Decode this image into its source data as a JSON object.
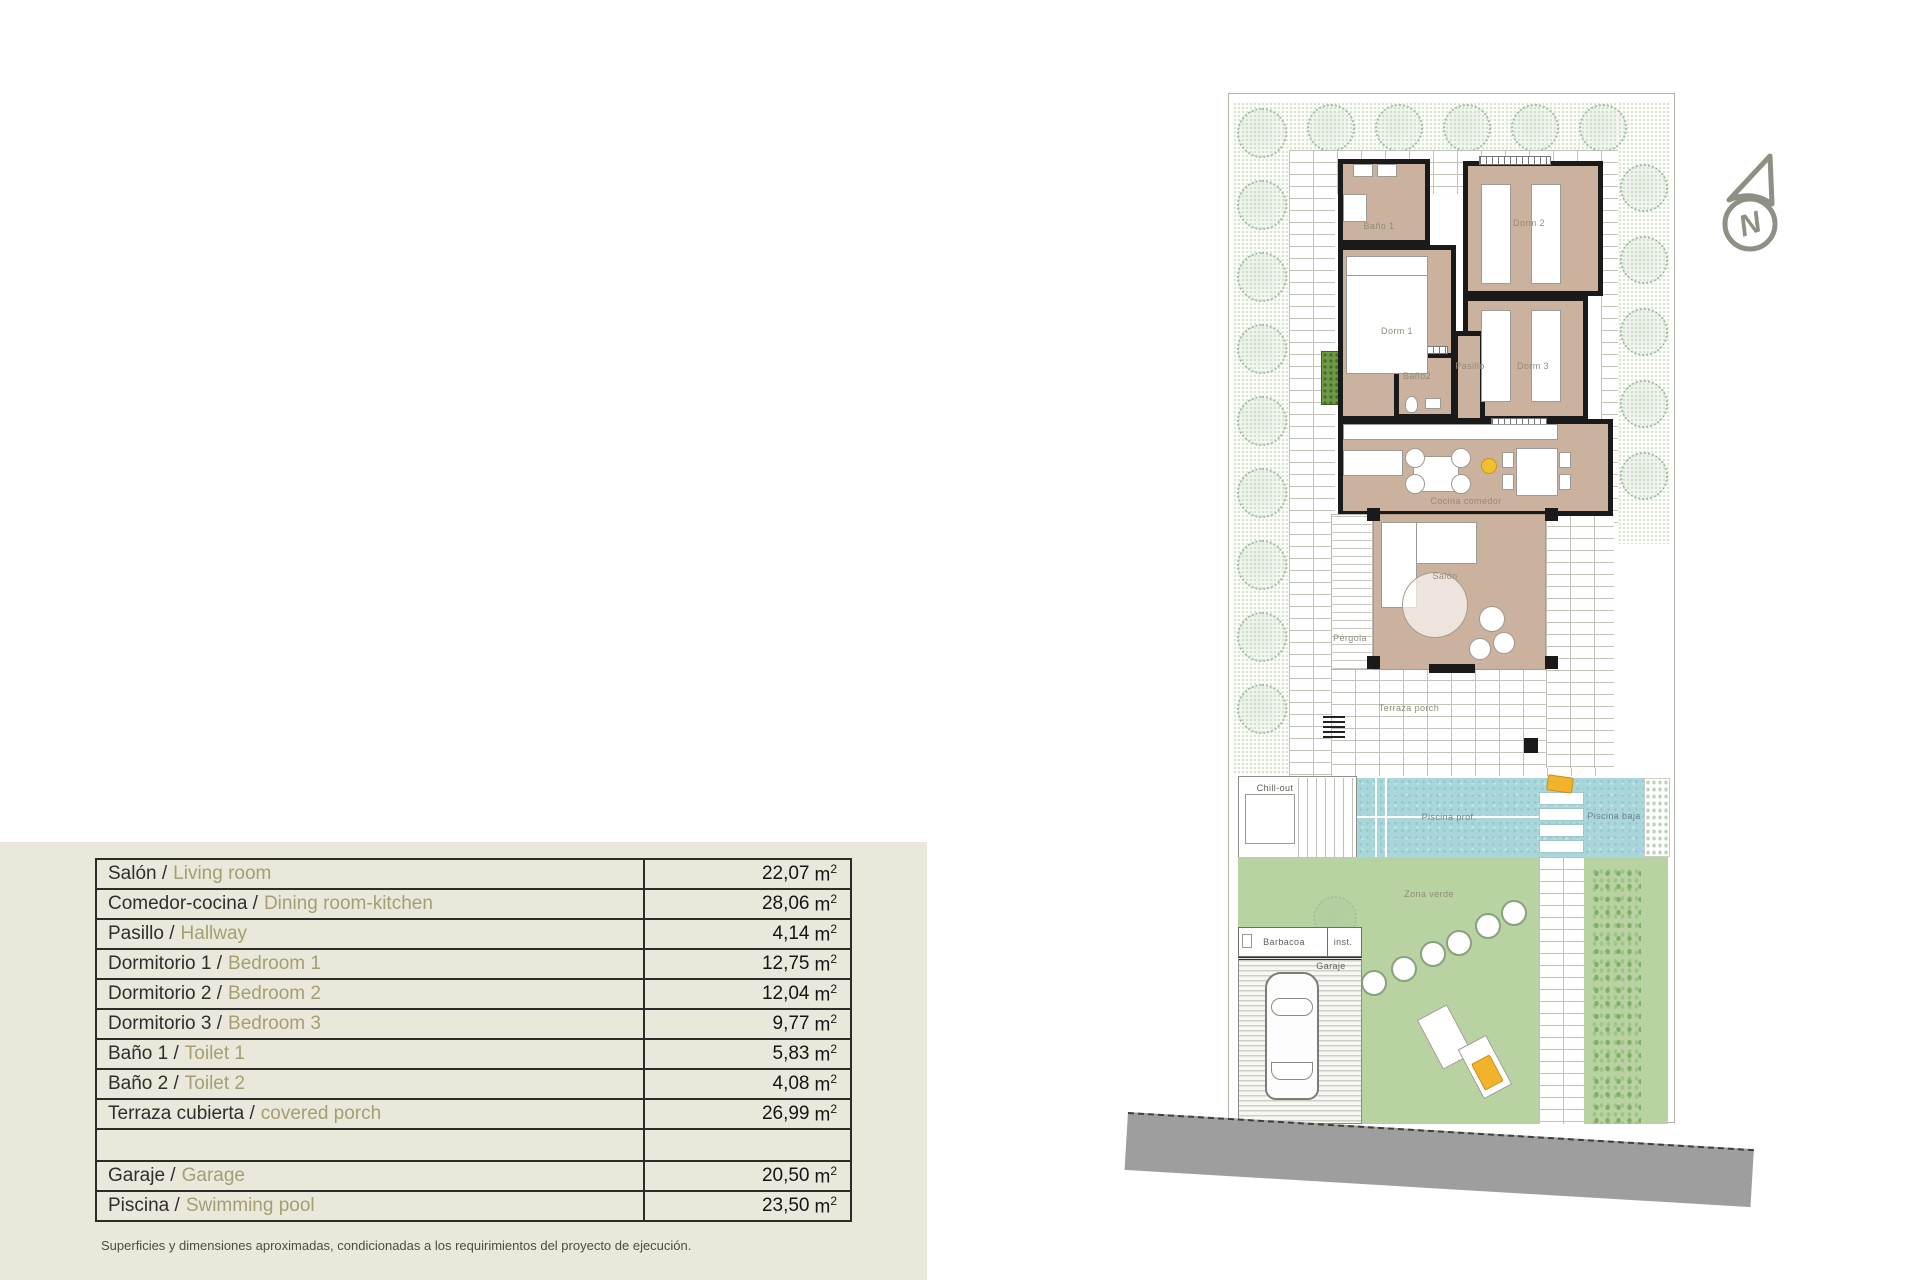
{
  "table": {
    "unit": "m",
    "unit_sup": "2",
    "rows": [
      {
        "es": "Salón /",
        "en": "Living room",
        "value": "22,07"
      },
      {
        "es": "Comedor-cocina /",
        "en": "Dining room-kitchen",
        "value": "28,06"
      },
      {
        "es": "Pasillo /",
        "en": "Hallway",
        "value": "4,14"
      },
      {
        "es": "Dormitorio 1 /",
        "en": "Bedroom 1",
        "value": "12,75"
      },
      {
        "es": "Dormitorio 2 /",
        "en": "Bedroom 2",
        "value": "12,04"
      },
      {
        "es": "Dormitorio 3 /",
        "en": "Bedroom 3",
        "value": "9,77"
      },
      {
        "es": "Baño 1 /",
        "en": "Toilet 1",
        "value": "5,83"
      },
      {
        "es": "Baño 2 /",
        "en": "Toilet 2",
        "value": "4,08"
      },
      {
        "es": "Terraza cubierta /",
        "en": "covered porch",
        "value": "26,99"
      },
      {
        "es": "",
        "en": "",
        "value": ""
      },
      {
        "es": "Garaje /",
        "en": "Garage",
        "value": "20,50"
      },
      {
        "es": "Piscina /",
        "en": "Swimming pool",
        "value": "23,50"
      }
    ],
    "footnote": "Superficies y dimensiones aproximadas, condicionadas a los requirimientos del proyecto de ejecución."
  },
  "plan": {
    "labels": {
      "bano1": "Baño 1",
      "dorm1": "Dorm 1",
      "dorm2": "Dorm 2",
      "dorm3": "Dorm 3",
      "bano2": "Baño2",
      "pasillo": "Pasillo",
      "cocina": "Cocina comedor",
      "salon": "Salón",
      "pergola": "Pérgola",
      "terraza": "Terraza porch",
      "chillout": "Chill-out",
      "piscina_prof": "Piscina prof.",
      "piscina_baja": "Piscina baja",
      "zona_verde": "Zona verde",
      "barbacoa": "Barbacoa",
      "inst": "inst.",
      "garaje": "Garaje"
    },
    "compass": {
      "letter": "N"
    },
    "colors": {
      "beige_panel": "#eae8da",
      "room_fill": "#cbb29e",
      "pool": "#a9d6da",
      "lawn": "#b9d2a2",
      "road": "#9e9e9e",
      "english_text": "#a49e72",
      "towel_accent": "#f2b32c"
    }
  }
}
